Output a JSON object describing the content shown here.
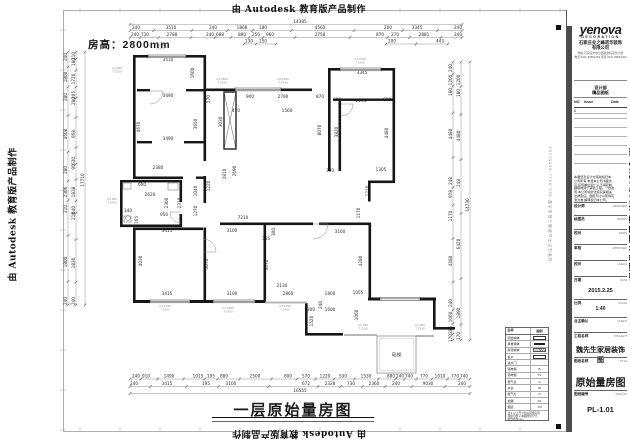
{
  "watermark": "由 Autodesk 教育版产品制作",
  "sheet": {
    "room_height": "房高：2800mm",
    "plan_title": "一层原始量房图",
    "side_address": "石家庄市中山西路三段金大厦  TEL:0311-89551263"
  },
  "plan": {
    "walls": [
      [
        133,
        55,
        73,
        2.6
      ],
      [
        133,
        55,
        2.6,
        124
      ],
      [
        203.5,
        55,
        2.6,
        106
      ],
      [
        137,
        89,
        13,
        2.4
      ],
      [
        186,
        89,
        20,
        2.4
      ],
      [
        137,
        141,
        15,
        2.4
      ],
      [
        184,
        141,
        22,
        2.4
      ],
      [
        133,
        176.5,
        50,
        2.6
      ],
      [
        120,
        180,
        2.6,
        47
      ],
      [
        120,
        180,
        62,
        2.4
      ],
      [
        120,
        224.5,
        62,
        2.6
      ],
      [
        179.5,
        180,
        2.6,
        22
      ],
      [
        179.5,
        214,
        2.6,
        13
      ],
      [
        203.5,
        176,
        2.6,
        27
      ],
      [
        196,
        176.5,
        10,
        2.4
      ],
      [
        206,
        88.5,
        106,
        2.6
      ],
      [
        328,
        68,
        67,
        2.6
      ],
      [
        392.5,
        68,
        2.6,
        115
      ],
      [
        328,
        68,
        2.6,
        103
      ],
      [
        333,
        98.5,
        60,
        2.4
      ],
      [
        338.5,
        101,
        2.6,
        70
      ],
      [
        368,
        180.5,
        27,
        2.6
      ],
      [
        368,
        180.5,
        2.6,
        21
      ],
      [
        220,
        222.5,
        93,
        2.6
      ],
      [
        319,
        222.5,
        52,
        2.6
      ],
      [
        368.5,
        222.5,
        2.6,
        77
      ],
      [
        133,
        227.5,
        70,
        2.6
      ],
      [
        203.5,
        227.5,
        2.6,
        75
      ],
      [
        263.5,
        222.5,
        2.6,
        80
      ],
      [
        133,
        227.5,
        2.6,
        75
      ],
      [
        133,
        300,
        132,
        3
      ],
      [
        305,
        303,
        2.6,
        31
      ],
      [
        305,
        333,
        38,
        2.6
      ],
      [
        368,
        297.5,
        68,
        3
      ],
      [
        433,
        300,
        2.6,
        29
      ],
      [
        433,
        327,
        22,
        2.6
      ]
    ],
    "windows": [
      [
        148,
        55,
        38
      ],
      [
        235,
        88,
        46
      ],
      [
        340,
        68,
        41
      ],
      [
        150,
        300,
        40
      ],
      [
        213,
        300,
        42
      ],
      [
        380,
        297.5,
        40
      ]
    ],
    "sills": [
      [
        265,
        301.5,
        42,
        2
      ],
      [
        344,
        334,
        33,
        2
      ],
      [
        416,
        335,
        18,
        2
      ]
    ],
    "shaft": [
      224,
      92,
      12,
      57
    ],
    "porch": [
      377,
      336,
      39,
      37
    ],
    "porch_label": "电梯",
    "arcs": [
      [
        150,
        91,
        13,
        1
      ],
      [
        181,
        212,
        11,
        2
      ],
      [
        313,
        224,
        15,
        1
      ],
      [
        203,
        252,
        13,
        3
      ],
      [
        341,
        104,
        12,
        1
      ]
    ],
    "fixtures": [
      [
        123,
        183,
        8,
        6
      ],
      [
        168,
        183,
        10,
        7
      ],
      [
        124,
        216,
        7,
        6
      ]
    ],
    "dimrows": [
      {
        "y": 24.5,
        "x1": 130,
        "x2": 462,
        "labels": [
          [
            300,
            "14385"
          ]
        ]
      },
      {
        "y": 30.5,
        "x1": 130,
        "x2": 462,
        "labels": [
          [
            136,
            "240"
          ],
          [
            171,
            "3510"
          ],
          [
            213,
            "240"
          ],
          [
            242,
            "1868"
          ],
          [
            263,
            "180"
          ],
          [
            320,
            "4560"
          ],
          [
            388,
            "200"
          ],
          [
            417,
            "3345"
          ],
          [
            458,
            "240"
          ]
        ]
      },
      {
        "y": 37.5,
        "x1": 130,
        "x2": 462,
        "labels": [
          [
            135,
            "240"
          ],
          [
            145,
            "730"
          ],
          [
            172,
            "2788"
          ],
          [
            210,
            "240"
          ],
          [
            220,
            "688"
          ],
          [
            242,
            "880"
          ],
          [
            256,
            "250"
          ],
          [
            270,
            "960"
          ],
          [
            320,
            "2758"
          ],
          [
            380,
            "870"
          ],
          [
            395,
            "270"
          ],
          [
            424,
            "2881"
          ],
          [
            458,
            "240"
          ]
        ]
      },
      {
        "y": 44,
        "x1": 244,
        "x2": 276,
        "labels": [
          [
            249,
            "130"
          ],
          [
            263,
            "150"
          ]
        ]
      },
      {
        "y": 44,
        "x1": 386,
        "x2": 448,
        "labels": [
          [
            392,
            "200"
          ],
          [
            440,
            "443"
          ]
        ]
      },
      {
        "y": 379,
        "x1": 130,
        "x2": 470,
        "labels": [
          [
            136,
            "240"
          ],
          [
            146,
            "910"
          ],
          [
            169,
            "1490"
          ],
          [
            198,
            "1015"
          ],
          [
            211,
            "195"
          ],
          [
            224,
            "880"
          ],
          [
            255,
            "2500"
          ],
          [
            288,
            "800"
          ],
          [
            306,
            "570"
          ],
          [
            325,
            "1220"
          ],
          [
            343,
            "530"
          ],
          [
            366,
            "1530"
          ],
          [
            391,
            "880"
          ],
          [
            400,
            "240"
          ],
          [
            409,
            "740"
          ],
          [
            424,
            "770"
          ],
          [
            440,
            "1010"
          ],
          [
            455,
            "770"
          ],
          [
            464,
            "740"
          ]
        ]
      },
      {
        "y": 386.5,
        "x1": 130,
        "x2": 470,
        "labels": [
          [
            134,
            "240"
          ],
          [
            167,
            "3415"
          ],
          [
            206,
            "195"
          ],
          [
            231,
            "3100"
          ],
          [
            306,
            "672"
          ],
          [
            330,
            "2328"
          ],
          [
            351,
            "730"
          ],
          [
            374,
            "2360"
          ],
          [
            396,
            "240"
          ],
          [
            428,
            "9030"
          ],
          [
            462,
            "240"
          ]
        ]
      },
      {
        "y": 393.5,
        "x1": 130,
        "x2": 470,
        "labels": [
          [
            300,
            "16555"
          ]
        ]
      }
    ],
    "dimcols": [
      {
        "x": 68,
        "y1": 52,
        "y2": 305,
        "labels": [
          [
            57,
            "240"
          ],
          [
            77,
            "1800"
          ],
          [
            97,
            "280"
          ],
          [
            134,
            "4608"
          ],
          [
            170,
            "280"
          ],
          [
            192,
            "2306"
          ],
          [
            209,
            "210"
          ],
          [
            262,
            "1800"
          ],
          [
            301,
            "240"
          ]
        ]
      },
      {
        "x": 76,
        "y1": 52,
        "y2": 305,
        "labels": [
          [
            56,
            "310"
          ],
          [
            62,
            "180"
          ],
          [
            79,
            "1720"
          ],
          [
            95,
            "205"
          ],
          [
            101,
            "280"
          ],
          [
            134,
            "958"
          ],
          [
            161,
            "630"
          ],
          [
            167,
            "95"
          ],
          [
            192,
            "1838"
          ],
          [
            210,
            "640"
          ],
          [
            216,
            "210"
          ],
          [
            263,
            "1830"
          ],
          [
            301,
            "240"
          ]
        ]
      },
      {
        "x": 85,
        "y1": 52,
        "y2": 305,
        "labels": [
          [
            180,
            "17710"
          ]
        ]
      },
      {
        "x": 453,
        "y1": 62,
        "y2": 340,
        "labels": [
          [
            68,
            "240"
          ],
          [
            80,
            "1200"
          ],
          [
            92,
            "180"
          ],
          [
            134,
            "4480"
          ],
          [
            181,
            "248"
          ],
          [
            194,
            "978"
          ],
          [
            216,
            "1170"
          ],
          [
            261,
            "4280"
          ],
          [
            303,
            "240"
          ],
          [
            317,
            "1060"
          ],
          [
            330,
            "385"
          ],
          [
            338,
            "170"
          ]
        ]
      },
      {
        "x": 461,
        "y1": 62,
        "y2": 340,
        "labels": [
          [
            80,
            "1200"
          ],
          [
            93,
            "180"
          ],
          [
            136,
            "4480"
          ],
          [
            183,
            "248"
          ],
          [
            244,
            "6420"
          ],
          [
            313,
            "1890"
          ],
          [
            336,
            "170"
          ]
        ]
      },
      {
        "x": 470,
        "y1": 62,
        "y2": 340,
        "labels": [
          [
            205,
            "14730"
          ]
        ]
      }
    ],
    "free": [
      [
        168,
        61,
        "3510",
        0
      ],
      [
        362,
        74,
        "3345",
        0
      ],
      [
        168,
        97,
        "3490",
        0
      ],
      [
        168,
        140,
        "3490",
        0
      ],
      [
        140,
        127,
        "4670",
        1
      ],
      [
        197,
        124,
        "3650",
        1
      ],
      [
        194,
        73,
        "1600",
        1
      ],
      [
        210,
        99,
        "570",
        1
      ],
      [
        250,
        98,
        "900",
        0
      ],
      [
        283,
        98,
        "2790",
        0
      ],
      [
        320,
        98,
        "870",
        0
      ],
      [
        337,
        101,
        "680",
        0
      ],
      [
        361,
        102,
        "2145",
        0
      ],
      [
        387,
        101,
        "600",
        0
      ],
      [
        287,
        112,
        "1560",
        0
      ],
      [
        236,
        112,
        "470",
        0
      ],
      [
        222,
        122,
        "3030",
        1
      ],
      [
        321,
        130,
        "8070",
        1
      ],
      [
        338,
        132,
        "3820",
        1
      ],
      [
        388,
        133,
        "4480",
        1
      ],
      [
        330,
        172,
        "300",
        0
      ],
      [
        381,
        171,
        "1305",
        0
      ],
      [
        226,
        174,
        "2810",
        1
      ],
      [
        236,
        171,
        "2690",
        1
      ],
      [
        369,
        191,
        "1210",
        1
      ],
      [
        360,
        213,
        "1170",
        1
      ],
      [
        210,
        186,
        "1220",
        1
      ],
      [
        197,
        191,
        "1040",
        1
      ],
      [
        197,
        211,
        "1270",
        1
      ],
      [
        158,
        169,
        "2380",
        0
      ],
      [
        142,
        186,
        "600",
        0
      ],
      [
        150,
        196,
        "2620",
        0
      ],
      [
        168,
        203,
        "2300",
        1
      ],
      [
        181,
        203,
        "2310",
        1
      ],
      [
        128,
        212,
        "340",
        0
      ],
      [
        164,
        216,
        "950",
        0
      ],
      [
        138,
        220,
        "165",
        1
      ],
      [
        243,
        219,
        "7210",
        0
      ],
      [
        167,
        232,
        "3415",
        0
      ],
      [
        232,
        232,
        "3100",
        0
      ],
      [
        275,
        232,
        "300",
        1
      ],
      [
        266,
        240,
        "365",
        0
      ],
      [
        340,
        233,
        "3160",
        0
      ],
      [
        142,
        261,
        "4030",
        1
      ],
      [
        208,
        264,
        "3070",
        1
      ],
      [
        268,
        265,
        "3670",
        1
      ],
      [
        362,
        261,
        "4280",
        1
      ],
      [
        282,
        287,
        "2130",
        0
      ],
      [
        288,
        295,
        "2860",
        0
      ],
      [
        167,
        295,
        "3415",
        0
      ],
      [
        232,
        295,
        "3100",
        0
      ],
      [
        330,
        295,
        "1800",
        0
      ],
      [
        358,
        294,
        "1055",
        0
      ],
      [
        330,
        311,
        "1600",
        0
      ],
      [
        322,
        305,
        "240",
        1
      ],
      [
        313,
        321,
        "1520",
        1
      ],
      [
        358,
        315,
        "1060",
        1
      ],
      [
        311,
        311,
        "300",
        0
      ]
    ],
    "tags": [
      [
        160,
        46,
        "C1:2306",
        "T:1420"
      ],
      [
        117,
        69,
        "C2:900",
        "T:2150"
      ],
      [
        222,
        80,
        "C1:1560",
        "T:1420"
      ],
      [
        283,
        80,
        "C2:2330",
        "T:1420"
      ],
      [
        360,
        60,
        "C1:2306",
        "T:1420"
      ],
      [
        112,
        200,
        "C2:900",
        "T:2150"
      ],
      [
        165,
        307,
        "C1:1530",
        "T:1420"
      ],
      [
        228,
        309,
        "C1:1860",
        "T:1420"
      ],
      [
        285,
        307,
        "C2:1490",
        "T:1420"
      ],
      [
        363,
        326,
        "C2:920",
        "T:2150"
      ],
      [
        420,
        326,
        "C2:920",
        "T:2150"
      ]
    ]
  },
  "legend": {
    "header": [
      "名称",
      "图例"
    ],
    "rows": [
      [
        "原始墙体",
        "box"
      ],
      [
        "承重墙体",
        "solid"
      ],
      [
        "新建墙体",
        "hatch"
      ],
      [
        "窗户",
        "win"
      ],
      [
        "进户门",
        ""
      ],
      [
        "强电箱",
        "B"
      ],
      [
        "弱电箱",
        "TV"
      ],
      [
        "燃气表",
        "G"
      ],
      [
        "水表",
        "W"
      ],
      [
        "暖气片",
        "N"
      ],
      [
        "地漏",
        "DL"
      ],
      [
        "烟道",
        "YD"
      ]
    ],
    "notes": [
      "注:1.以上尺寸均以现场实际",
      "测量为准;2.本图所注尺寸",
      "单位均为mm。"
    ]
  },
  "titleblock": {
    "logo": "yenova",
    "logo_sub": "DECORATION",
    "company1": "石家庄业之峰诺华装饰",
    "company2": "有限公司",
    "addr1": "地址:石家庄市中山西路金指商务大厦",
    "addr2": "电话:0311-89551263 传真:0311-89551262",
    "box2a": "设计部",
    "box2b": "精品图纸",
    "issue_header": [
      "NO.",
      "Issue",
      "Date"
    ],
    "issue_rows": [
      "A",
      ""
    ],
    "disclaimer": [
      "本图纸及设计方案版权归本",
      "公司所有,未经本公司书面许",
      "可,任何单位和个人不得复制",
      "翻版或用于其他工程。一经发",
      "现,本公司将依法追究其相关",
      "法律责任。图纸尺寸以现场实",
      "测为准,解释权归本公司。"
    ],
    "rows": [
      {
        "label": "设计师",
        "en": "DESIGNER",
        "value": "",
        "h": 13,
        "fs": 0
      },
      {
        "label": "绘图员",
        "en": "DRAWN",
        "value": "",
        "h": 14,
        "fs": 0
      },
      {
        "label": "校对",
        "en": "DRAW",
        "value": "",
        "h": 15,
        "fs": 0
      },
      {
        "label": "审核",
        "en": "APPROVED",
        "value": "",
        "h": 16,
        "fs": 0
      },
      {
        "label": "校对",
        "en": "CHECK",
        "value": "",
        "h": 16,
        "fs": 0
      },
      {
        "label": "日期",
        "en": "DATE",
        "value": "2015.2.25",
        "h": 23,
        "fs": 5.5
      },
      {
        "label": "比例",
        "en": "SCALE",
        "value": "1:40",
        "h": 18,
        "fs": 5
      },
      {
        "label": "业主确认",
        "en": "CLIENT",
        "value": "",
        "h": 15,
        "fs": 0
      },
      {
        "label": "工程名称",
        "en": "PROJECT",
        "value": "魏先生家居装饰图",
        "h": 25,
        "fs": 7
      },
      {
        "label": "图纸名称",
        "en": "TITLE",
        "value": "原始量房图",
        "h": 33,
        "fs": 10
      },
      {
        "label": "图纸编号",
        "en": "DWG.NO",
        "value": "PL-1.01",
        "h": 30,
        "fs": 7.5
      }
    ]
  }
}
